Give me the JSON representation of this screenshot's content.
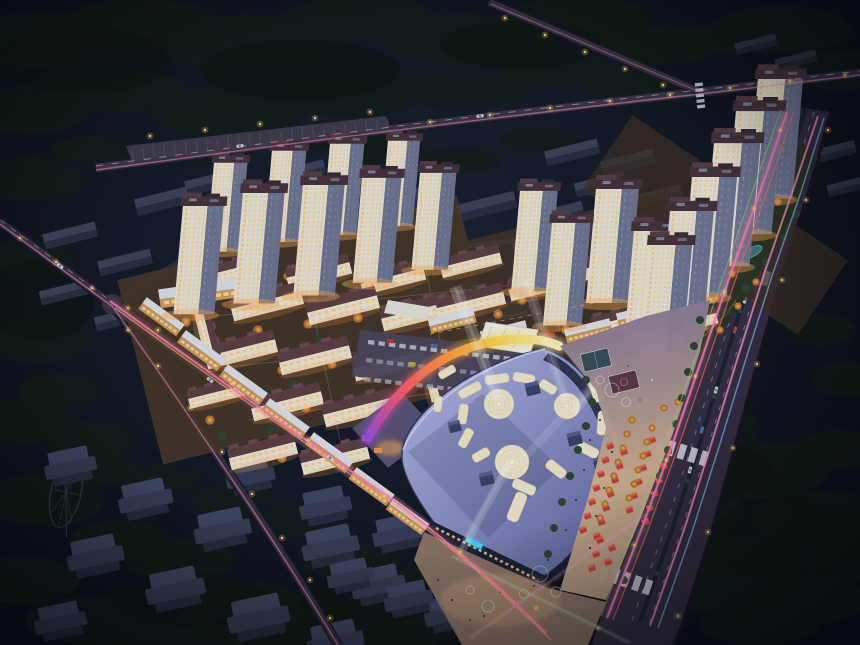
{
  "meta": {
    "title": "Aerial night rendering of a mixed-use residential development with shopping mall",
    "type": "architectural-rendering",
    "time": "night",
    "view": "aerial oblique"
  },
  "palette": {
    "bg_center": "#1a2233",
    "bg_mid": "#10141f",
    "bg_edge": "#070a11",
    "forest_dark": "#121c14",
    "forest_deep": "#0d140f",
    "road_surface": "#3a3444",
    "road_casing": "#1b1724",
    "avenue_surface": "#332d40",
    "trail_pink": "#ff7fae",
    "trail_blue": "#8fb6ff",
    "trail_green": "#9fd86a",
    "trail_orange": "#ffab6b",
    "trail_red": "#ff6a6a",
    "street_lamp": "#ffd36b",
    "tower_lit": "#e9e6da",
    "tower_shade": "#6e7590",
    "tower_crown": "#46303a",
    "window_warm": "#ffc87e",
    "midrise_roof": "#5c3e42",
    "midrise_face": "#efe7d4",
    "tree_green": "#2c4530",
    "tree_orange": "#b5742e",
    "mall_roof_light": "#b2b6e6",
    "mall_roof_mid": "#8b90c4",
    "mall_roof_dark": "#5f649a",
    "roof_pattern_cream": "#f1e9cd",
    "beam_white": "#ffffff",
    "rainbow_purple": "#a050d8",
    "rainbow_red": "#ff5a6e",
    "rainbow_orange": "#ff9a3c",
    "rainbow_yellow": "#ffd84e",
    "rainbow_pale": "#fff3b8",
    "plaza_dusk": "#8f7f95",
    "plaza_warm": "#d4b392",
    "plaza_tan": "#b3987e",
    "stall_red": "#c5403a",
    "sign_cyan": "#45d5ff",
    "pond_teal": "#3f7a80"
  },
  "scene": {
    "tower_clusters": [
      {
        "name": "west",
        "towers": 9
      },
      {
        "name": "central",
        "towers": 4
      },
      {
        "name": "east",
        "towers": 6
      }
    ],
    "midrise_blocks": 24,
    "retail_strips": 13,
    "mall": {
      "roof_pattern": "dotted S-curve with 3 round medallions",
      "searchlight_beams": 5,
      "rainbow_band": true,
      "parking_rows": 3
    },
    "market_stalls": 31,
    "unlit_blocks": true,
    "ferris_wheel": true,
    "light_trails": [
      "pink",
      "red",
      "blue",
      "green",
      "orange"
    ]
  }
}
